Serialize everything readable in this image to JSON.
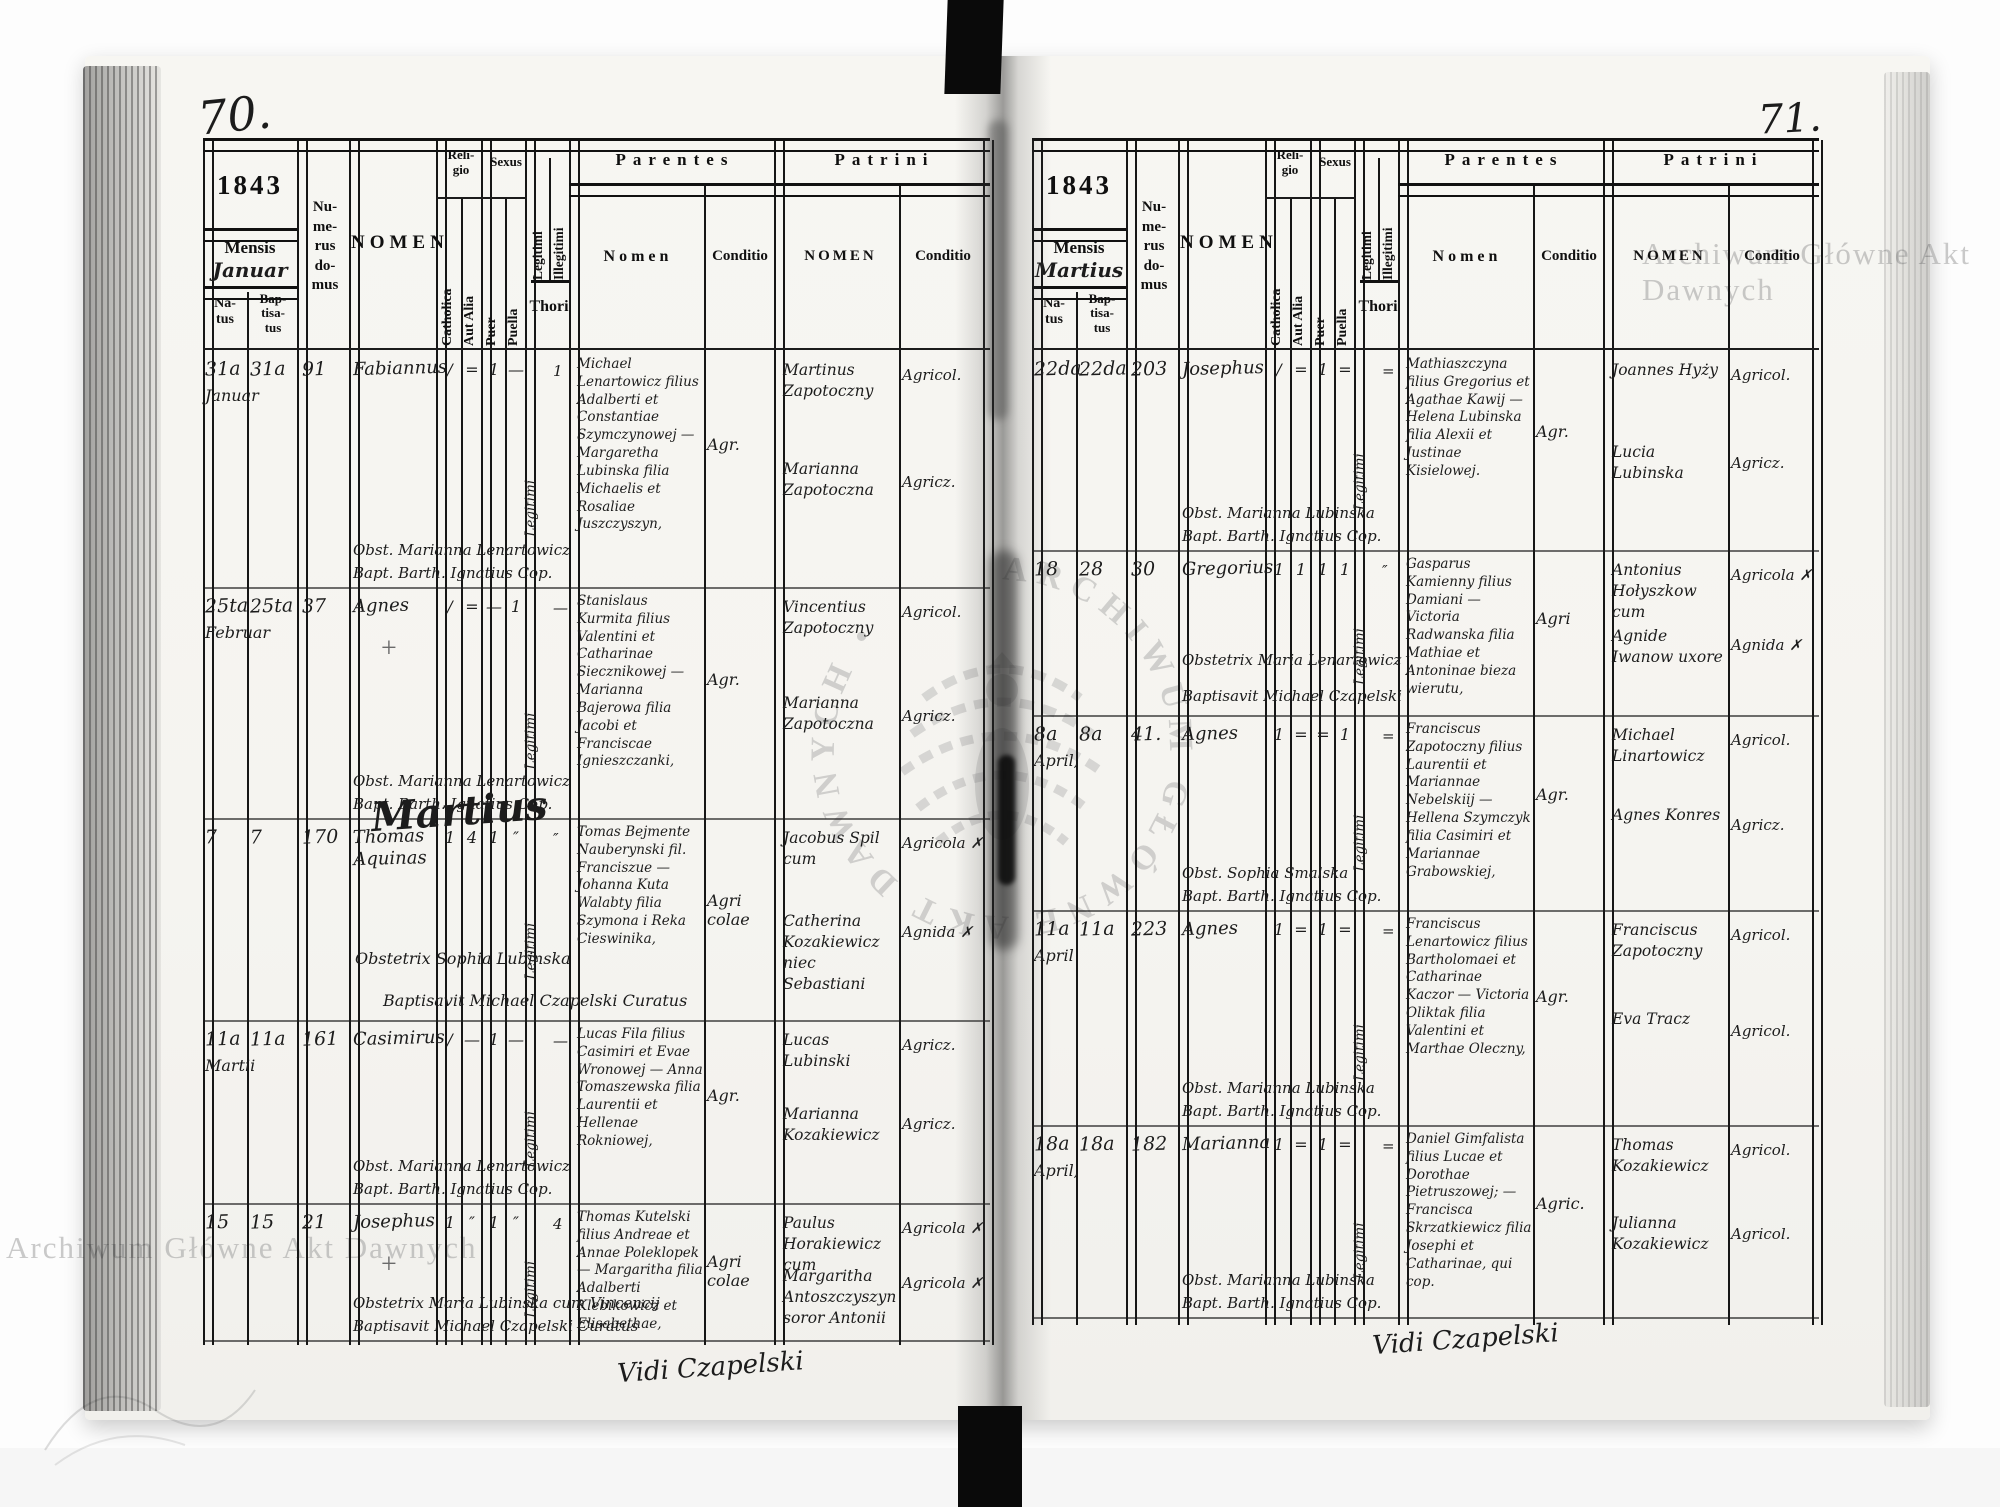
{
  "watermark": {
    "text": "Archiwum Główne Akt Dawnych",
    "ring_text": "ARCHIWUM GŁÓWNE AKT DAWNYCH •"
  },
  "labels": {
    "mensis": "Mensis",
    "natus": "Na-\ntus",
    "baptisatus": "Bap-\ntisa-\ntus",
    "numerus": "Nu-\nme-\nrus\ndo-\nmus",
    "nomen": "NOMEN",
    "religio": "Reli-\ngio",
    "catholica": "Catholica",
    "aut_alia": "Aut Alia",
    "sexus": "Sexus",
    "puer": "Puer",
    "puella": "Puella",
    "legitimi": "Legitimi",
    "illegitimi": "Illegitimi",
    "thori": "Thori",
    "parentes": "Parentes",
    "nomen_lc": "Nomen",
    "conditio": "Conditio",
    "patrini": "Patrini",
    "nomen_uc": "NOMEN"
  },
  "left": {
    "page_number": "70.",
    "year": "1843",
    "month": "Januar",
    "footer": "Vidi Czapelski",
    "entries": [
      {
        "natus": "31a",
        "baptisatus": "31a",
        "month": "Januar",
        "numerus": "91",
        "nomen": "Fabiannus",
        "mark": "",
        "m1": "/",
        "m2": "=",
        "m3": "1",
        "m4": "—",
        "legitimi": "Legitimi",
        "m5": "1",
        "parentes": "Michael Lenartowicz filius Adalberti et Constantiae Szymczynowej — Margaretha Lubinska filia Michaelis et Rosaliae Juszczyszyn,",
        "parentes_cond": "Agr.",
        "obstetrix": "Obst. Marianna Lenartowicz",
        "baptisavit": "Bapt. Barth. Ignatius Cop.",
        "patrini1": "Martinus Zapotoczny",
        "patrini1_cond": "Agricol.",
        "patrini2": "Marianna Zapotoczna",
        "patrini2_cond": "Agricz."
      },
      {
        "natus": "25ta",
        "baptisatus": "25ta",
        "month": "Februar",
        "numerus": "37",
        "nomen": "Agnes",
        "mark": "+",
        "m1": "/",
        "m2": "=",
        "m3": "—",
        "m4": "1",
        "legitimi": "Legitimi",
        "m5": "—",
        "parentes": "Stanislaus Kurmita filius Valentini et Catharinae Siecznikowej — Marianna Bajerowa filia Jacobi et Franciscae Ignieszczanki,",
        "parentes_cond": "Agr.",
        "obstetrix": "Obst. Marianna Lenartowicz",
        "baptisavit": "Bapt. Barth. Ignatius Cop.",
        "patrini1": "Vincentius Zapotoczny",
        "patrini1_cond": "Agricol.",
        "patrini2": "Marianna Zapotoczna",
        "patrini2_cond": "Agricz."
      },
      {
        "natus": "7",
        "baptisatus": "7",
        "month": "",
        "numerus": "170",
        "nomen": "Thomas Aquinas",
        "mark": "",
        "flourish": "Martius",
        "m1": "1",
        "m2": "4",
        "m3": "1",
        "m4": "″",
        "legitimi": "Legitimi",
        "m5": "″",
        "parentes": "Tomas Bejmente Nauberynski fil. Franciszue — Johanna Kuta Walabty filia Szymona i Reka Cieswinika,",
        "parentes_cond": "Agri\ncolae",
        "obstetrix": "Obstetrix Sophia Lubinska",
        "baptisavit": "Baptisavit Michael Czapelski Curatus",
        "patrini1": "Jacobus Spil cum",
        "patrini1_cond": "Agricola ✗",
        "patrini2": "Catherina Kozakiewicz niec Sebastiani",
        "patrini2_cond": "Agnida ✗"
      },
      {
        "natus": "11a",
        "baptisatus": "11a",
        "month": "Martii",
        "numerus": "161",
        "nomen": "Casimirus",
        "mark": "",
        "m1": "/",
        "m2": "—",
        "m3": "1",
        "m4": "—",
        "legitimi": "Legitimi",
        "m5": "—",
        "parentes": "Lucas Fila filius Casimiri et Evae Wronowej — Anna Tomaszewska filia Laurentii et Hellenae Rokniowej,",
        "parentes_cond": "Agr.",
        "obstetrix": "Obst. Marianna Lenartowicz",
        "baptisavit": "Bapt. Barth. Ignatius Cop.",
        "patrini1": "Lucas Lubinski",
        "patrini1_cond": "Agricz.",
        "patrini2": "Marianna Kozakiewicz",
        "patrini2_cond": "Agricz."
      },
      {
        "natus": "15",
        "baptisatus": "15",
        "month": "",
        "numerus": "21",
        "nomen": "Josephus",
        "mark": "+",
        "m1": "1",
        "m2": "″",
        "m3": "1",
        "m4": "″",
        "legitimi": "Legitimi",
        "m5": "4",
        "parentes": "Thomas Kutelski filius Andreae et Annae Poleklopek — Margaritha filia Adalberti Klebikowicz et Elisabethae,",
        "parentes_cond": "Agri\ncolae",
        "obstetrix": "Obstetrix Maria Lubinska cum Vincencij",
        "baptisavit": "Baptisavit Michael Czapelski Curatus",
        "patrini1": "Paulus Horakiewicz cum",
        "patrini1_cond": "Agricola ✗",
        "patrini2": "Margaritha Antoszczyszyn soror Antonii",
        "patrini2_cond": "Agricola ✗"
      }
    ]
  },
  "right": {
    "page_number": "71.",
    "year": "1843",
    "month": "Martius",
    "footer": "Vidi Czapelski",
    "entries": [
      {
        "natus": "22da",
        "baptisatus": "22da",
        "month": "",
        "numerus": "203",
        "nomen": "Josephus",
        "mark": "",
        "m1": "/",
        "m2": "=",
        "m3": "1",
        "m4": "=",
        "legitimi": "Legitimi",
        "m5": "=",
        "parentes": "Mathiaszczyna filius Gregorius et Agathae Kawij — Helena Lubinska filia Alexii et Justinae Kisielowej.",
        "parentes_cond": "Agr.",
        "obstetrix": "Obst. Marianna Lubinska",
        "baptisavit": "Bapt. Barth. Ignatius Cop.",
        "patrini1": "Joannes Hyży",
        "patrini1_cond": "Agricol.",
        "patrini2": "Lucia Lubinska",
        "patrini2_cond": "Agricz."
      },
      {
        "natus": "18",
        "baptisatus": "28",
        "month": "",
        "numerus": "30",
        "nomen": "Gregorius",
        "mark": "",
        "m1": "1",
        "m2": "1",
        "m3": "1",
        "m4": "1",
        "legitimi": "Legitimi",
        "m5": "″",
        "parentes": "Gasparus Kamienny filius Damiani — Victoria Radwanska filia Mathiae et Antoninae bieza wierutu,",
        "parentes_cond": "Agri",
        "obstetrix": "Obstetrix Maria Lenartowicz",
        "baptisavit": "Baptisavit Michael Czapelski",
        "patrini1": "Antonius Hołyszkow cum",
        "patrini1_cond": "Agricola ✗",
        "patrini2": "Agnide Iwanow uxore",
        "patrini2_cond": "Agnida ✗"
      },
      {
        "natus": "8a",
        "baptisatus": "8a",
        "month": "April,",
        "numerus": "41.",
        "nomen": "Agnes",
        "mark": "",
        "m1": "1",
        "m2": "=",
        "m3": "=",
        "m4": "1",
        "legitimi": "Legitimi",
        "m5": "=",
        "parentes": "Franciscus Zapotoczny filius Laurentii et Mariannae Nebelskiij — Hellena Szymczyk filia Casimiri et Mariannae Grabowskiej,",
        "parentes_cond": "Agr.",
        "obstetrix": "Obst. Sophia Smalska",
        "baptisavit": "Bapt. Barth. Ignatius Cop.",
        "patrini1": "Michael Linartowicz",
        "patrini1_cond": "Agricol.",
        "patrini2": "Agnes Konres",
        "patrini2_cond": "Agricz."
      },
      {
        "natus": "11a",
        "baptisatus": "11a",
        "month": "April",
        "numerus": "223",
        "nomen": "Agnes",
        "mark": "",
        "m1": "1",
        "m2": "=",
        "m3": "1",
        "m4": "=",
        "legitimi": "Legitimi",
        "m5": "=",
        "parentes": "Franciscus Lenartowicz filius Bartholomaei et Catharinae Kaczor — Victoria Oliktak filia Valentini et Marthae Oleczny,",
        "parentes_cond": "Agr.",
        "obstetrix": "Obst. Marianna Lubinska",
        "baptisavit": "Bapt. Barth. Ignatius Cop.",
        "patrini1": "Franciscus Zapotoczny",
        "patrini1_cond": "Agricol.",
        "patrini2": "Eva Tracz",
        "patrini2_cond": "Agricol."
      },
      {
        "natus": "18a",
        "baptisatus": "18a",
        "month": "April,",
        "numerus": "182",
        "nomen": "Marianna",
        "mark": "",
        "m1": "1",
        "m2": "=",
        "m3": "1",
        "m4": "=",
        "legitimi": "Legitimi",
        "m5": "=",
        "parentes": "Daniel Gimfalista filius Lucae et Dorothae Pietruszowej; — Francisca Skrzatkiewicz filia Josephi et Catharinae, qui cop.",
        "parentes_cond": "Agric.",
        "obstetrix": "Obst. Marianna Lubinska",
        "baptisavit": "Bapt. Barth. Ignatius Cop.",
        "patrini1": "Thomas Kozakiewicz",
        "patrini1_cond": "Agricol.",
        "patrini2": "Julianna Kozakiewicz",
        "patrini2_cond": "Agricol."
      }
    ]
  }
}
